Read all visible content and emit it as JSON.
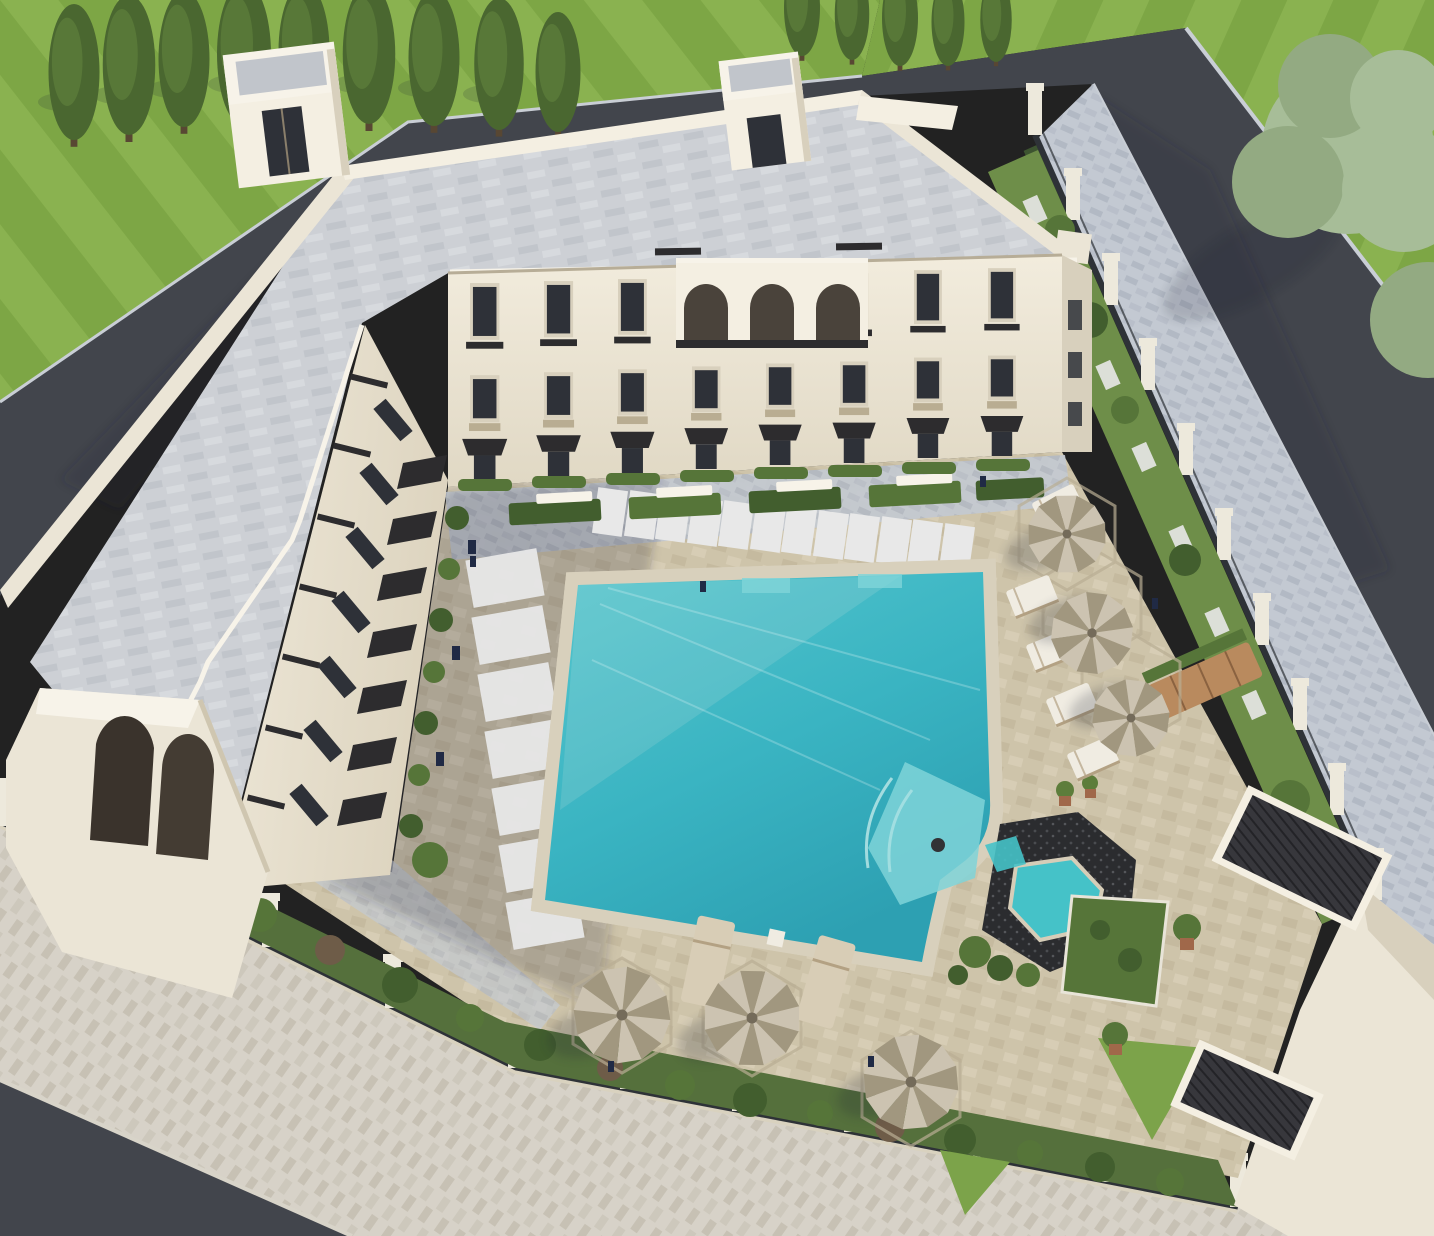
{
  "scene": {
    "type": "aerial-3d-architectural-rendering",
    "subject": "U-shaped cream apartment complex with landscaped courtyard swimming pool",
    "view": "high bird's-eye perspective",
    "setting": "walled residential block bordered by asphalt streets and striped lawns with trees"
  },
  "building": {
    "stories": 3,
    "wings": 2,
    "roof": "flat gray paver roof deck with parapet",
    "rooftop_stair_towers": 2,
    "facade": "cream stucco, dark framed windows, dark metal balcony railings, dark slatted awnings",
    "center_feature": "arched third-floor loggia",
    "ground_floor": "terraces with hedge planters and benches",
    "corner_feature": "double-arched covered entry at south-west corner"
  },
  "courtyard": {
    "pool": {
      "color": "turquoise",
      "features": [
        "entry steps",
        "tanning ledge with curved steps",
        "attached spa with dark stone surround"
      ],
      "border": "white stone coping"
    },
    "umbrellas": 6,
    "umbrella_style": "pleated tan-and-gray round market umbrellas on hexagon tile pads",
    "sun_loungers_white": 5,
    "sun_loungers_tan": 2,
    "stepping_stone_paths": 2,
    "hedge_planters_with_benches": 9,
    "potted_plants": [
      "agaves",
      "boxwood trees in terracotta pots"
    ]
  },
  "landscape": {
    "lawn": "mowed grass with light/dark stripes",
    "trees": [
      "row of slender cypress-like trees upper-left",
      "small grove top-center",
      "large pale-green tree right"
    ],
    "perimeter_fence": "cream masonry pillars with black metal railings",
    "inner_planting": "hedge walls and shrub borders inside the fence",
    "hardscape": [
      "dark asphalt street upper-right",
      "asphalt service strip upper-left",
      "asphalt street lower-left corner",
      "light stone paver sidewalks",
      "dark stone stair flights lower-right"
    ]
  },
  "palette": {
    "grass": "#7da645",
    "grass_stripe": "#8ab250",
    "tree_dark": "#4a6730",
    "tree_mid": "#5d7d3b",
    "tree_pale": "#a7bd98",
    "tree_pale2": "#93aa82",
    "trunk": "#584733",
    "asphalt": "#42454c",
    "curb": "#c9ced5",
    "side_cool": "#c3c9d2",
    "side_cool2": "#b2b9c4",
    "side_warm": "#d7d2c8",
    "side_warm2": "#c7c1b4",
    "roof": "#cdd0d5",
    "roof2": "#c1c5cb",
    "roof3": "#d7dade",
    "cream": "#ebe5d6",
    "cream_lit": "#f4efe2",
    "cream_shade": "#d8d0bd",
    "trim": "#f7f3e9",
    "win": "#2e3138",
    "awn": "#2d2c2e",
    "deck": "#cec4aa",
    "deck2": "#c3b89c",
    "deck3": "#d9d0b8",
    "stone": "#e8e8e8",
    "coping": "#ece8dc",
    "coping_band": "#d8d0bc",
    "water": "#55c6ce",
    "water_mid": "#3ab4c2",
    "water_deep": "#2da0b2",
    "water_light": "#7fd4d8",
    "spa_stone": "#2b2c2f",
    "spa_water": "#45c2c8",
    "hedge": "#425e2e",
    "hedge2": "#567539",
    "hedge_red": "#6e5c48",
    "strip_green": "#6e8e49",
    "lawn_patch": "#7ca34a",
    "umbA": "#ccc3b1",
    "umbB": "#a1977f",
    "umbC": "#746b5a",
    "lounge_w": "#f0ece2",
    "lounge_t": "#d8cdb6",
    "frame_tan": "#b3a183",
    "wood": "#b98a5e",
    "rail": "#2e3237",
    "pillar": "#ede9dc",
    "stair": "#37373c",
    "pot": "#a0684a",
    "navy": "#202a45"
  }
}
